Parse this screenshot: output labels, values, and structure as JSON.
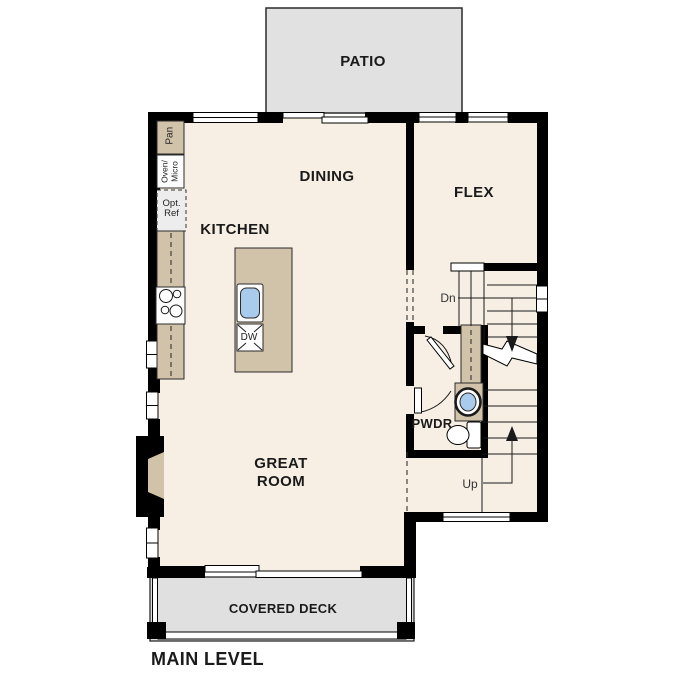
{
  "title": "MAIN LEVEL",
  "rooms": {
    "patio": "PATIO",
    "dining": "DINING",
    "flex": "FLEX",
    "kitchen": "KITCHEN",
    "great_room": {
      "line1": "GREAT",
      "line2": "ROOM"
    },
    "powder": "PWDR",
    "covered_deck": "COVERED DECK"
  },
  "fixtures": {
    "pantry": "Pan",
    "oven_micro": {
      "line1": "Oven/",
      "line2": "Micro"
    },
    "opt_ref": {
      "line1": "Opt.",
      "line2": "Ref"
    },
    "dishwasher": "DW"
  },
  "stairs": {
    "down": "Dn",
    "up": "Up"
  },
  "colors": {
    "wall": "#000000",
    "floor": "#f7efe4",
    "cabinet": "#d1c3a9",
    "patio": "#e1e1e1",
    "deck": "#e0e0e0",
    "appliance": "#ededed",
    "sink": "#a9cbec",
    "text": "#1a1a1a"
  }
}
